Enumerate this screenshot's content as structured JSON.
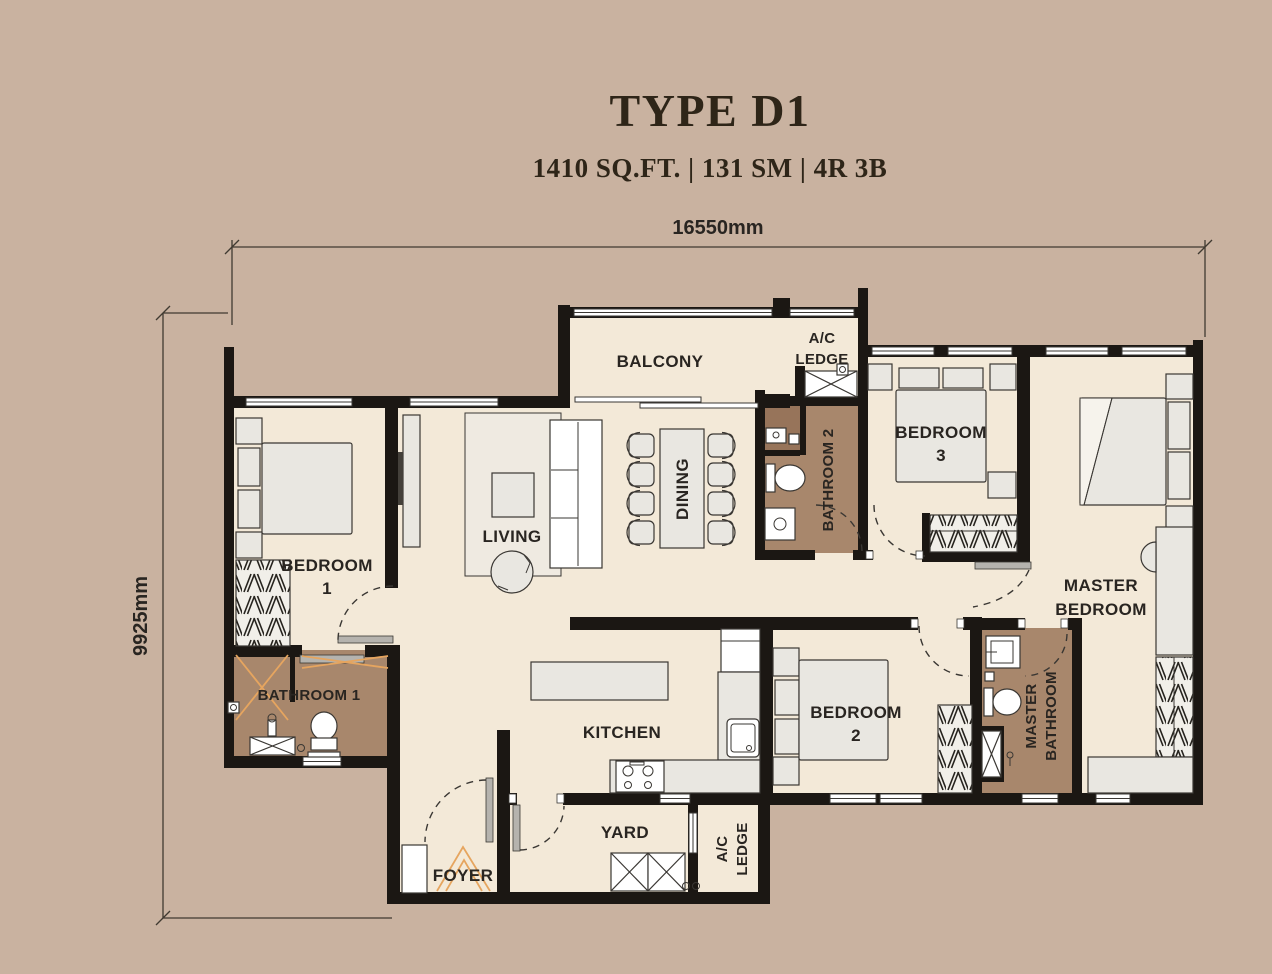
{
  "title": "TYPE D1",
  "subtitle": "1410 SQ.FT. | 131 SM | 4R 3B",
  "dimensions": {
    "width_label": "16550mm",
    "height_label": "9925mm"
  },
  "rooms": {
    "balcony": "BALCONY",
    "ac_ledge_top": {
      "line1": "A/C",
      "line2": "LEDGE"
    },
    "bedroom3": {
      "line1": "BEDROOM",
      "line2": "3"
    },
    "master_bedroom": {
      "line1": "MASTER",
      "line2": "BEDROOM"
    },
    "bedroom1": {
      "line1": "BEDROOM",
      "line2": "1"
    },
    "living": "LIVING",
    "dining": "DINING",
    "bathroom2": "BATHROOM 2",
    "bathroom1": "BATHROOM 1",
    "kitchen": "KITCHEN",
    "bedroom2": {
      "line1": "BEDROOM",
      "line2": "2"
    },
    "master_bathroom": {
      "line1": "MASTER",
      "line2": "BATHROOM"
    },
    "yard": "YARD",
    "ac_ledge_bottom": {
      "line1": "A/C",
      "line2": "LEDGE"
    },
    "foyer": "FOYER"
  },
  "colors": {
    "bg": "#c9b2a0",
    "floor": "#f3e9d8",
    "bath": "#a8876c",
    "bath-dark": "#97745a",
    "wall": "#1b1713",
    "furn": "#e9e7e1",
    "rug": "#efeae1",
    "line": "#3a3733",
    "accent": "#e6a55f",
    "text": "#292521",
    "panel": "#b5b3ae",
    "title": "#2e2518"
  }
}
